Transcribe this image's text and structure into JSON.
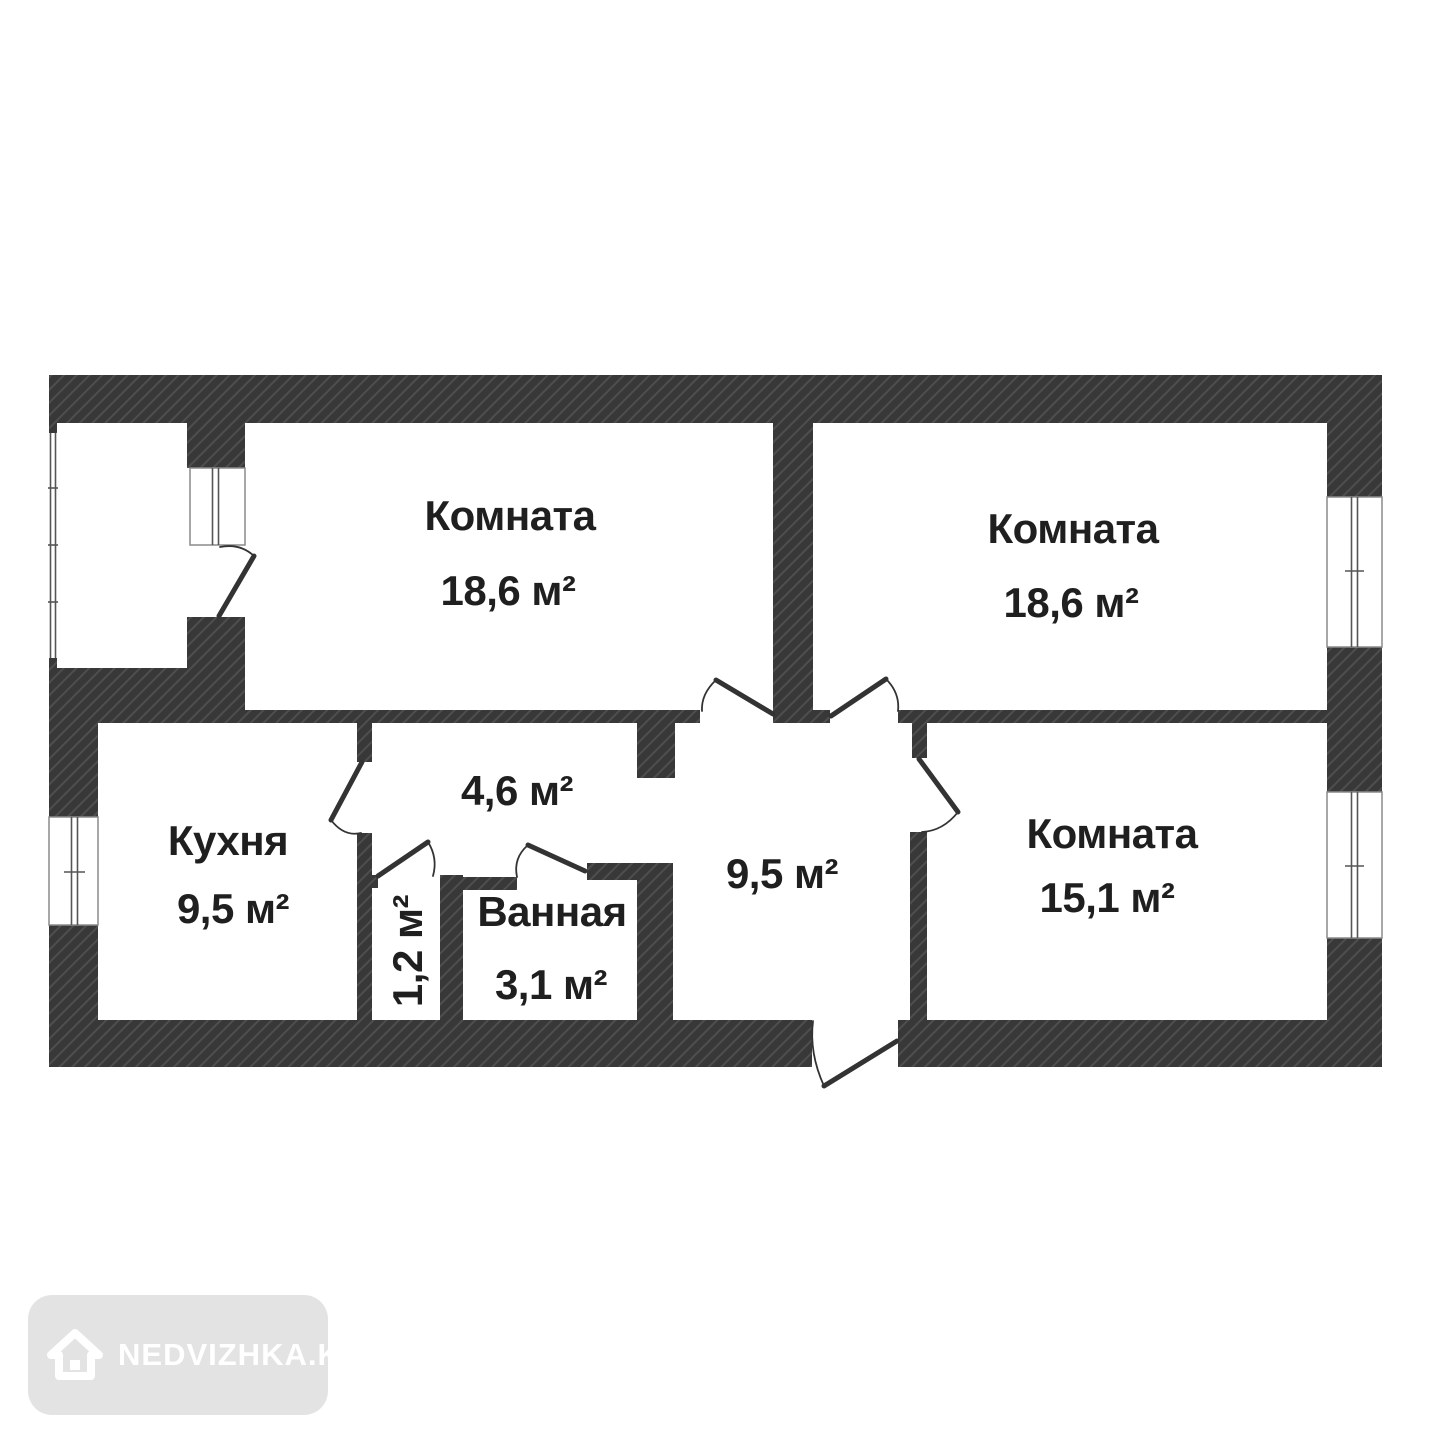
{
  "plan_title": "apartment-floor-plan",
  "rooms": [
    {
      "key": "room-top-left",
      "name": "Комната",
      "area": "18,6 м²"
    },
    {
      "key": "room-top-right",
      "name": "Комната",
      "area": "18,6 м²"
    },
    {
      "key": "kitchen",
      "name": "Кухня",
      "area": "9,5 м²"
    },
    {
      "key": "hallway",
      "name": "",
      "area": "4,6 м²"
    },
    {
      "key": "wc",
      "name": "",
      "area": "1,2 м²"
    },
    {
      "key": "bathroom",
      "name": "Ванная",
      "area": "3,1 м²"
    },
    {
      "key": "entrance-hall",
      "name": "",
      "area": "9,5 м²"
    },
    {
      "key": "room-right",
      "name": "Комната",
      "area": "15,1 м²"
    }
  ],
  "watermark": {
    "label": "NEDVIZHKA.KZ",
    "icon": "house-icon"
  },
  "colors": {
    "wall": "#383838",
    "wall_hatch": "#4e4e4e",
    "label_text": "#1f1f1f",
    "window_frame": "#8a8a8a",
    "glazing": "#555555",
    "door": "#333333",
    "watermark_bg": "#e3e3e3",
    "watermark_fg": "#ffffff",
    "background": "#ffffff"
  }
}
